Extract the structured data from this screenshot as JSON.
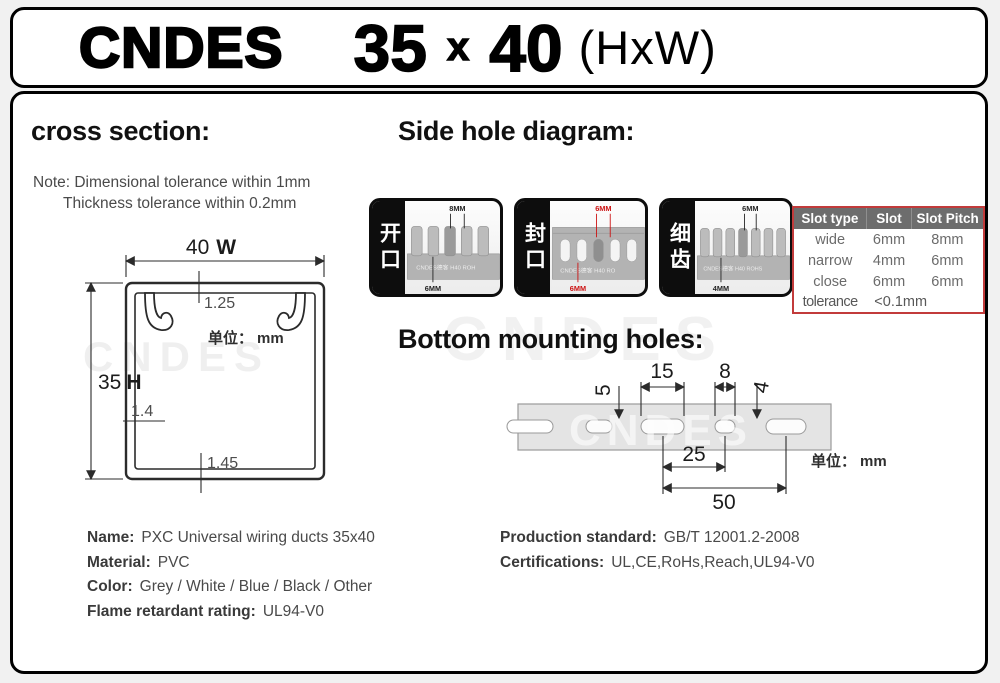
{
  "colors": {
    "table_border": "#c23b3b",
    "table_header_bg": "#6d6d6d",
    "dim_red": "#cc1111",
    "dim_black": "#222222",
    "panel_border": "#000000"
  },
  "header": {
    "brand": "CNDES",
    "size_h": "35",
    "size_x": "x",
    "size_w": "40",
    "suffix": "(HxW)"
  },
  "cross_section": {
    "title": "cross section:",
    "note_line1": "Note: Dimensional tolerance within 1mm",
    "note_line2": "Thickness tolerance within 0.2mm",
    "width_dim": "40",
    "width_label": "W",
    "height_dim": "35",
    "height_label": "H",
    "top_thickness": "1.25",
    "side_thickness": "1.4",
    "bottom_thickness": "1.45",
    "unit_label": "单位：",
    "unit_value": "mm",
    "watermark": "CNDES"
  },
  "side_hole": {
    "title": "Side hole diagram:",
    "watermark": "CNDES",
    "thumbs": [
      {
        "label": "开口",
        "top_dim": "8MM",
        "bottom_dim": "6MM",
        "duct_text": "CNDES德客 H40 ROH",
        "dim_color": "#222222"
      },
      {
        "label": "封口",
        "top_dim": "6MM",
        "bottom_dim": "6MM",
        "duct_text": "CNDES德客 H40 RO",
        "dim_color": "#cc1111"
      },
      {
        "label": "细齿",
        "top_dim": "6MM",
        "bottom_dim": "4MM",
        "duct_text": "CNDES德客 H40 ROHS",
        "dim_color": "#222222"
      }
    ],
    "table": {
      "headers": [
        "Slot type",
        "Slot",
        "Slot Pitch"
      ],
      "rows": [
        [
          "wide",
          "6mm",
          "8mm"
        ],
        [
          "narrow",
          "4mm",
          "6mm"
        ],
        [
          "close",
          "6mm",
          "6mm"
        ]
      ],
      "tolerance_label": "tolerance",
      "tolerance_value": "<0.1mm"
    }
  },
  "bottom_holes": {
    "title": "Bottom mounting holes:",
    "watermark": "CNDES",
    "dim_15": "15",
    "dim_8": "8",
    "dim_5": "5",
    "dim_4": "4",
    "dim_25": "25",
    "dim_50": "50",
    "unit_label": "单位：",
    "unit_value": "mm"
  },
  "specs": {
    "left": [
      {
        "label": "Name:",
        "value": "PXC Universal wiring ducts 35x40"
      },
      {
        "label": "Material:",
        "value": "PVC"
      },
      {
        "label": "Color:",
        "value": "Grey / White / Blue / Black / Other"
      },
      {
        "label": "Flame retardant rating:",
        "value": "UL94-V0"
      }
    ],
    "right": [
      {
        "label": "Production standard:",
        "value": "GB/T 12001.2-2008"
      },
      {
        "label": "Certifications:",
        "value": "UL,CE,RoHs,Reach,UL94-V0"
      }
    ]
  }
}
